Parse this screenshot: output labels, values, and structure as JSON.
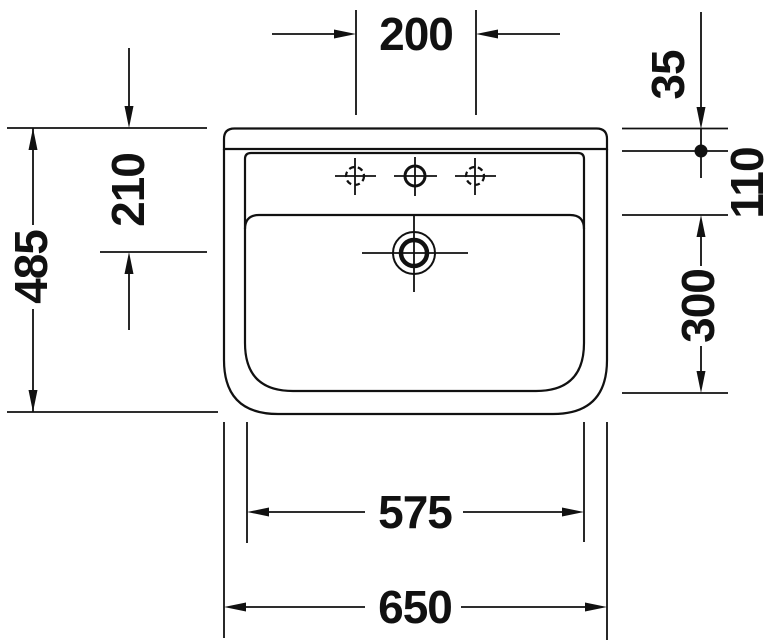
{
  "drawing": {
    "subject": "washbasin-dimension-drawing",
    "colors": {
      "line": "#111111",
      "background": "#ffffff"
    },
    "dimensions": {
      "faucet_hole_spacing": "200",
      "top_edge_to_fixing_point": "35",
      "fixing_point_to_bowl_edge": "110",
      "top_edge_to_drain_center": "210",
      "overall_depth": "485",
      "bowl_inner_depth": "300",
      "inner_width": "575",
      "overall_width": "650"
    }
  }
}
